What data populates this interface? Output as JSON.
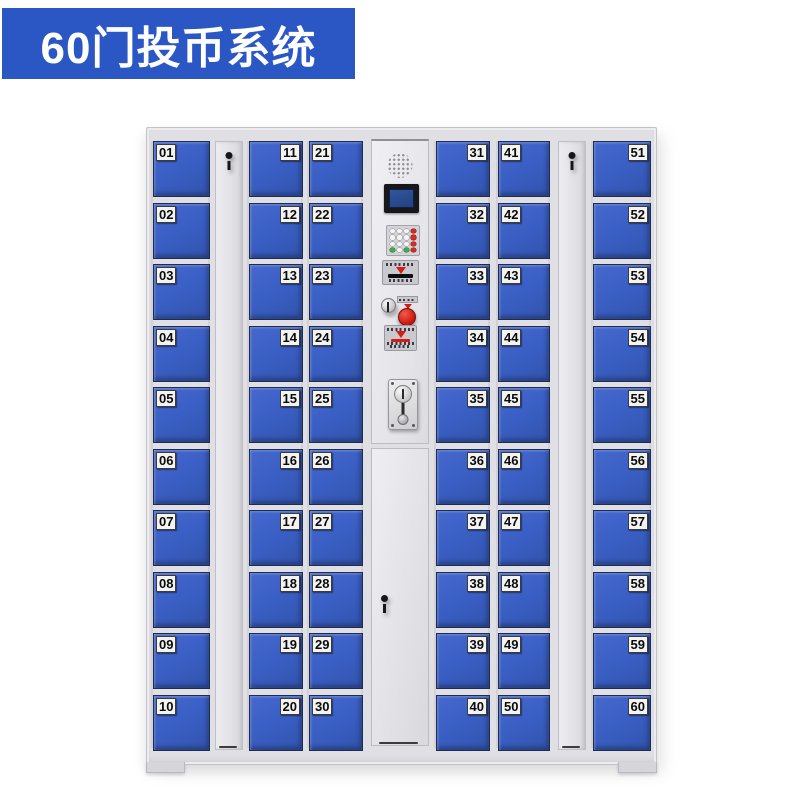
{
  "banner": {
    "title": "60门投币系统",
    "bg_color": "#2b57c4",
    "text_color": "#ffffff"
  },
  "locker": {
    "total_doors": 60,
    "door_color": "#3a5fc4",
    "frame_color": "#e0e0e4",
    "accent_colors": {
      "red": "#d41e14",
      "green": "#3fae4a",
      "screen_blue": "#27478c"
    },
    "columns": [
      {
        "name": "door-column-1",
        "type": "doors",
        "label_side": "left",
        "doors": [
          "01",
          "02",
          "03",
          "04",
          "05",
          "06",
          "07",
          "08",
          "09",
          "10"
        ]
      },
      {
        "name": "lock-strip-left",
        "type": "lock-strip",
        "icon": "keyhole-icon"
      },
      {
        "name": "door-column-2",
        "type": "doors",
        "label_side": "right",
        "doors": [
          "11",
          "12",
          "13",
          "14",
          "15",
          "16",
          "17",
          "18",
          "19",
          "20"
        ]
      },
      {
        "name": "door-column-3",
        "type": "doors",
        "label_side": "left",
        "doors": [
          "21",
          "22",
          "23",
          "24",
          "25",
          "26",
          "27",
          "28",
          "29",
          "30"
        ]
      },
      {
        "name": "control-column",
        "type": "control",
        "components": [
          "speaker-grill",
          "lcd-display",
          "keypad",
          "banknote-slot",
          "service-lock",
          "stop-button",
          "coin-return",
          "coin-acceptor",
          "service-door"
        ]
      },
      {
        "name": "door-column-4",
        "type": "doors",
        "label_side": "right",
        "doors": [
          "31",
          "32",
          "33",
          "34",
          "35",
          "36",
          "37",
          "38",
          "39",
          "40"
        ]
      },
      {
        "name": "door-column-5",
        "type": "doors",
        "label_side": "left",
        "doors": [
          "41",
          "42",
          "43",
          "44",
          "45",
          "46",
          "47",
          "48",
          "49",
          "50"
        ]
      },
      {
        "name": "lock-strip-right",
        "type": "lock-strip",
        "icon": "keyhole-icon"
      },
      {
        "name": "door-column-6",
        "type": "doors",
        "label_side": "right",
        "doors": [
          "51",
          "52",
          "53",
          "54",
          "55",
          "56",
          "57",
          "58",
          "59",
          "60"
        ]
      }
    ]
  }
}
